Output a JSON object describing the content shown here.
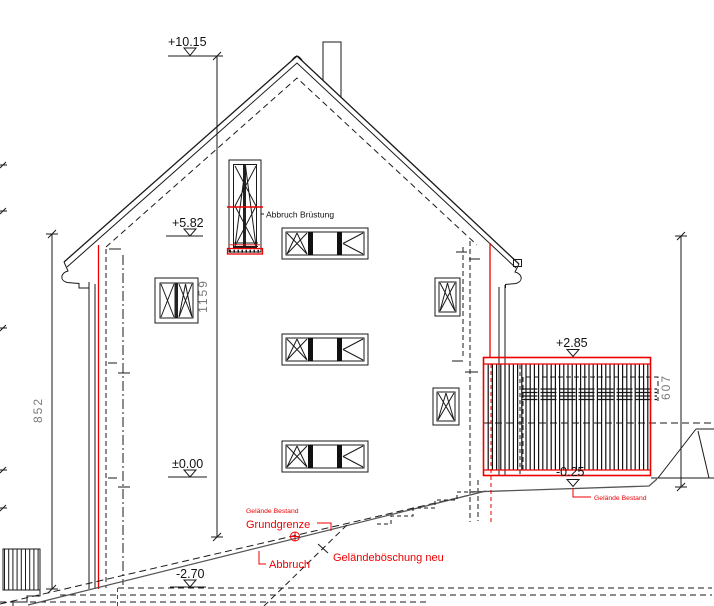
{
  "drawing": {
    "elevations": {
      "ridge": "+10.15",
      "eave": "+5.82",
      "floor": "±0.00",
      "terrace_top": "+2.85",
      "terrace_base": "-0.25",
      "basement": "-2.70"
    },
    "dimensions": {
      "left_total": "852",
      "center_total": "1159",
      "right_total": "607"
    },
    "annotations": {
      "parapet_demolition": "Abbruch Brüstung",
      "existing_grade_left": "Gelände Bestand",
      "property_line": "Grundgrenze",
      "demolition": "Abbruch",
      "new_embankment": "Geländeböschung neu",
      "existing_grade_right": "Gelände Bestand"
    },
    "colors": {
      "demolition_red": "#ee0000",
      "dimension_gray": "#7a7a7a",
      "line_black": "#1a1a1a"
    }
  }
}
